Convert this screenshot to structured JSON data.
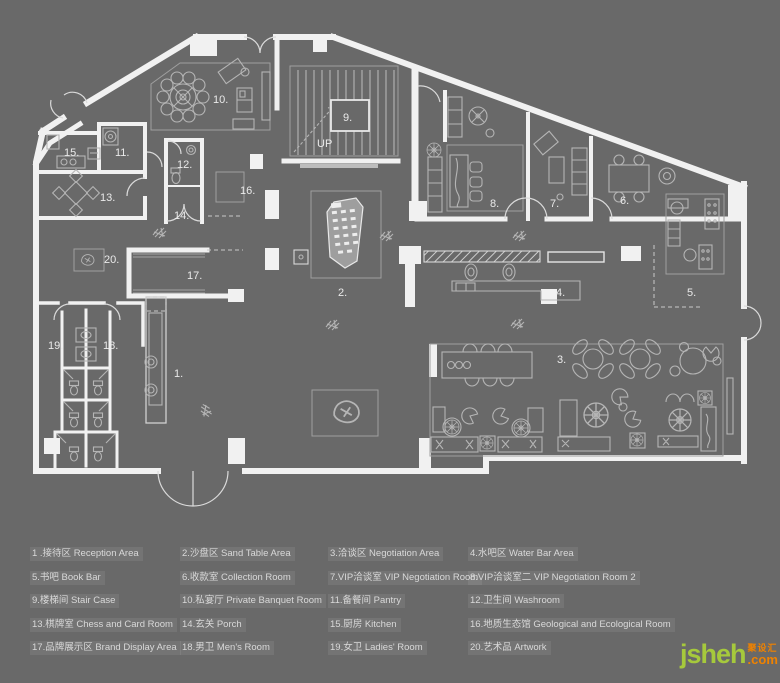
{
  "page": {
    "background_color": "#696969",
    "wall_color": "#f1f1f1",
    "furniture_line_color": "#b5b5b5",
    "label_color": "#eaeaea"
  },
  "plan": {
    "labels": [
      {
        "text": "1.",
        "x": 174,
        "y": 377
      },
      {
        "text": "2.",
        "x": 338,
        "y": 296
      },
      {
        "text": "3.",
        "x": 557,
        "y": 363
      },
      {
        "text": "4.",
        "x": 556,
        "y": 296
      },
      {
        "text": "5.",
        "x": 687,
        "y": 296
      },
      {
        "text": "6.",
        "x": 620,
        "y": 204
      },
      {
        "text": "7.",
        "x": 550,
        "y": 207
      },
      {
        "text": "8.",
        "x": 490,
        "y": 207
      },
      {
        "text": "9.",
        "x": 343,
        "y": 121
      },
      {
        "text": "10.",
        "x": 213,
        "y": 103
      },
      {
        "text": "11.",
        "x": 115,
        "y": 156
      },
      {
        "text": "12.",
        "x": 177,
        "y": 168
      },
      {
        "text": "13.",
        "x": 100,
        "y": 201
      },
      {
        "text": "14.",
        "x": 174,
        "y": 219
      },
      {
        "text": "15.",
        "x": 64,
        "y": 156
      },
      {
        "text": "16.",
        "x": 240,
        "y": 194
      },
      {
        "text": "17.",
        "x": 187,
        "y": 279
      },
      {
        "text": "18.",
        "x": 103,
        "y": 349
      },
      {
        "text": "19.",
        "x": 48,
        "y": 349
      },
      {
        "text": "20.",
        "x": 104,
        "y": 263
      },
      {
        "text": "UP",
        "x": 317,
        "y": 147,
        "size": 8
      }
    ]
  },
  "legend": {
    "items": [
      "1 .接待区 Reception Area",
      "2.沙盘区 Sand Table Area",
      "3.洽谈区 Negotiation Area",
      "4.水吧区 Water Bar Area",
      "5.书吧 Book Bar",
      "6.收款室 Collection Room",
      "7.VIP洽谈室 VIP Negotiation Room",
      "8.VIP洽谈室二 VIP Negotiation Room 2",
      "9.楼梯间 Stair Case",
      "10.私宴厅 Private Banquet Room",
      "11.备餐间 Pantry",
      "12.卫生间 Washroom",
      "13.棋牌室 Chess and Card Room",
      "14.玄关 Porch",
      "15.厨房 Kitchen",
      "16.地质生态馆 Geological and Ecological Room",
      "17.品牌展示区 Brand Display Area",
      "18.男卫 Men's Room",
      "19.女卫 Ladies' Room",
      "20.艺术品 Artwork"
    ]
  },
  "watermark": {
    "name": "jsheh",
    "cn": "聚设汇",
    "suffix": ".com",
    "green": "#a6c93c",
    "orange": "#ef8200"
  }
}
